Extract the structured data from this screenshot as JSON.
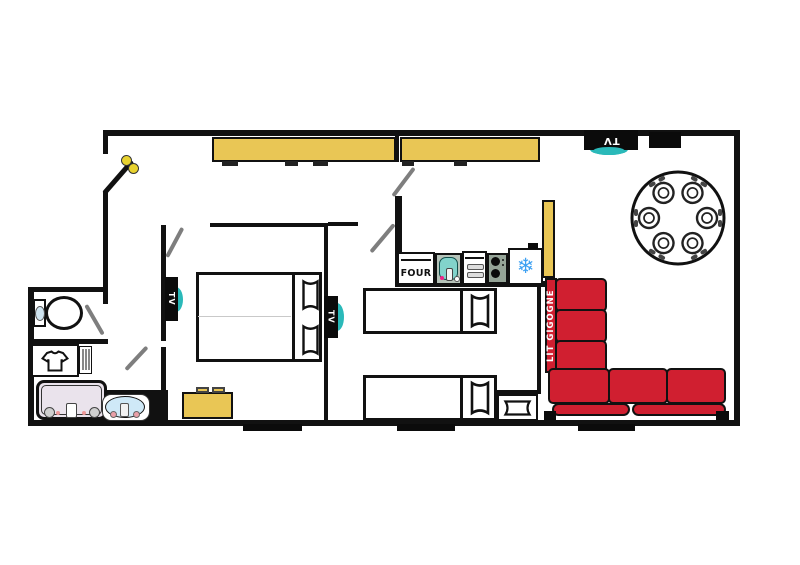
{
  "labels": {
    "oven": "FOUR",
    "sofa_bed": "LIT GIGOGNE",
    "tv": "TV"
  },
  "icons": {
    "snowflake-icon": "❄",
    "key-icon": "two yellow dots on entrance door leaf",
    "tshirt-icon": "t-shirt outline in bathroom cabinet"
  },
  "colors": {
    "wall_black": "#111111",
    "furniture_yellow": "#e9c655",
    "sofa_red": "#d01f30",
    "accent_teal": "#2ab9b9",
    "snowflake_blue": "#3da0f2",
    "door_gray": "#7e7e7e",
    "sink_blue": "#cfe9f7",
    "counter_green": "#b6c3b9",
    "stove_green": "#95a497",
    "shower_inner": "#eae3ec",
    "key_yellow": "#e8d22f"
  },
  "plate_count_dining_table": 6,
  "window_count_bottom_wall": 3
}
